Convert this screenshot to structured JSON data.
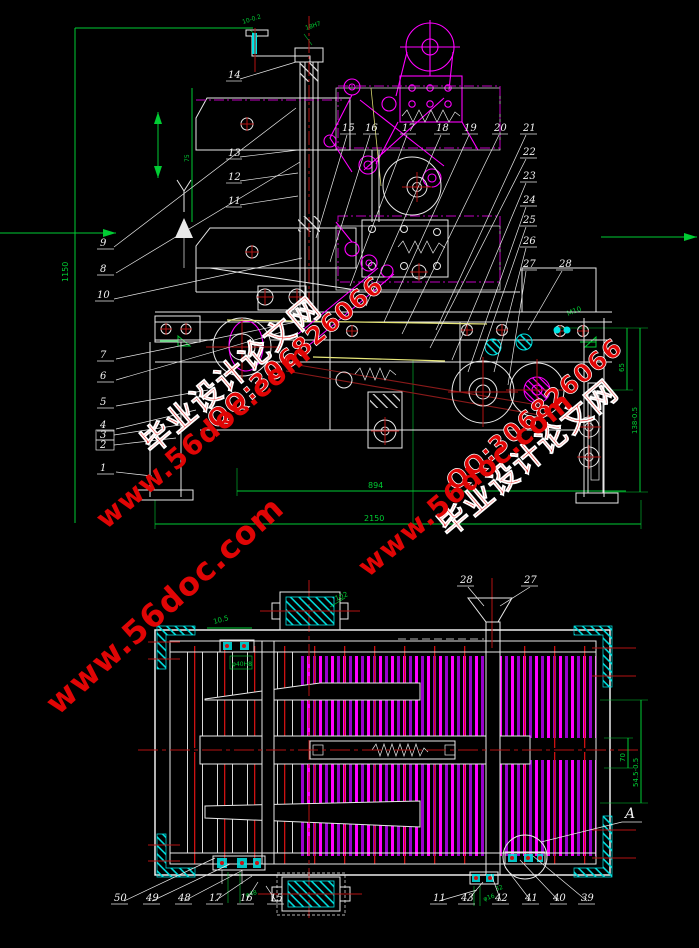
{
  "app": {
    "type": "CAD assembly drawing",
    "background": "#000000"
  },
  "palette": {
    "line": "#e9e9e9",
    "dimension": "#00cc33",
    "mechanism": "#ff00ff",
    "centerline": "#b31212",
    "highlight": "#00ffff",
    "belt": "#e8e87a",
    "watermark": "#e00505"
  },
  "watermark": {
    "brand": "毕业设计论文网",
    "site": "www.56doc.com",
    "qq": "QQ:306826066"
  },
  "front_view": {
    "labels_left": [
      "9",
      "8",
      "10",
      "7",
      "6",
      "5",
      "4",
      "3",
      "2",
      "1"
    ],
    "labels_mid": [
      "14",
      "13",
      "12",
      "11"
    ],
    "labels_fan": [
      "15",
      "16",
      "17",
      "18",
      "19",
      "20"
    ],
    "labels_right": [
      "21",
      "22",
      "23",
      "24",
      "25",
      "26",
      "27",
      "28"
    ],
    "dims": {
      "overall_height": "1150",
      "column": "75",
      "top_left": "10-0.2",
      "top_right": "18H7",
      "mid_right": "M10",
      "right_inner": "65",
      "right_outer": "138-0.5",
      "bottom_inner": "894",
      "bottom_overall": "2150"
    }
  },
  "plan_view": {
    "labels_top": [
      "28",
      "27"
    ],
    "labels_bottom_left": [
      "50",
      "49",
      "48",
      "17",
      "16",
      "15"
    ],
    "labels_bottom_right": [
      "11",
      "43",
      "42",
      "41",
      "40",
      "39"
    ],
    "detail": "A",
    "dims": {
      "top_left": "10.5",
      "bearing_box": "φ40H8",
      "motor": "102",
      "right_inner": "70",
      "right_outer": "54.5-0.5",
      "bottom_fit": "φ16",
      "bottom_len": "32",
      "bottom_left": "φ48"
    }
  }
}
